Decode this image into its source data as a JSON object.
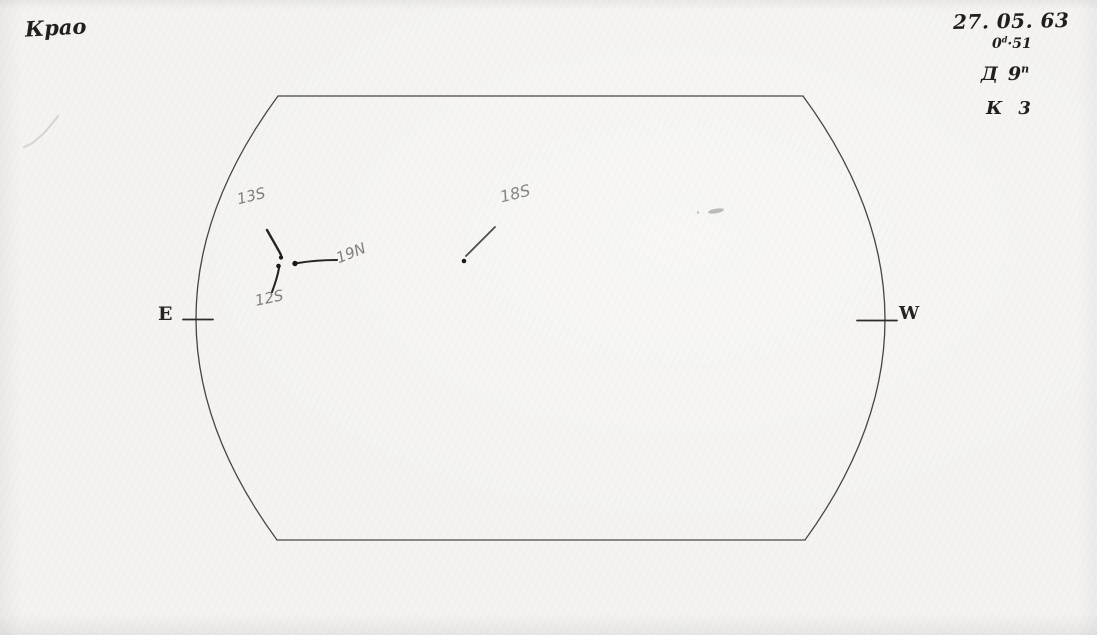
{
  "corner": {
    "observatory_label": "Крао"
  },
  "header": {
    "date": "27. 05. 63",
    "time": {
      "base": "0",
      "sup": "d",
      "rest": "·51"
    },
    "param_d": {
      "symbol": "Д",
      "value": "9",
      "sup": "n"
    },
    "param_k": {
      "symbol": "К",
      "value": "3"
    }
  },
  "disk": {
    "east_label": "E",
    "west_label": "W"
  },
  "spots": [
    {
      "label": "13S"
    },
    {
      "label": "12S"
    },
    {
      "label": "19N"
    },
    {
      "label": "18S"
    }
  ],
  "colors": {
    "paper": "#f4f3f1",
    "ink": "#211e1b",
    "pencil": "#858585",
    "outline": "#4a4641"
  }
}
